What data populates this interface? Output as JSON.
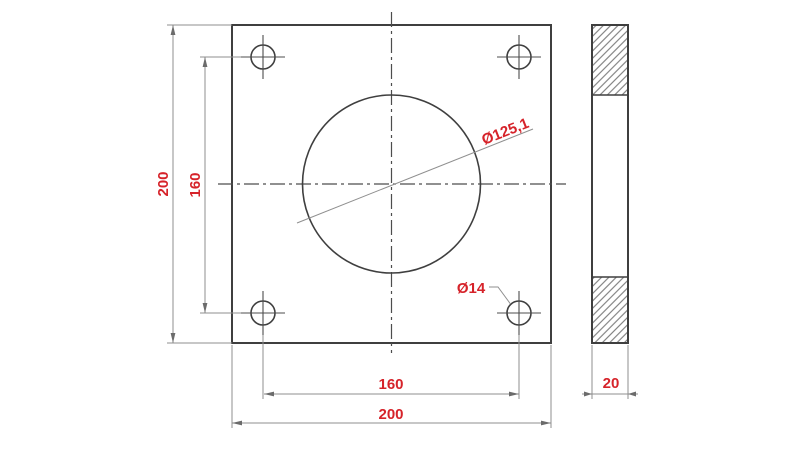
{
  "page": {
    "background": "#ffffff"
  },
  "drawing": {
    "type": "engineering-drawing",
    "subject": "square flange plate - front view with center bore and four bolt holes, plus side section view",
    "front_view": {
      "plate_height_dim": "200",
      "hole_spacing_vertical_dim": "160",
      "hole_spacing_horizontal_dim": "160",
      "plate_width_dim": "200",
      "center_hole_dia": "Ø125,1",
      "bolt_hole_dia": "Ø14"
    },
    "side_view": {
      "thickness_dim": "20"
    },
    "values": {
      "plate_width_mm": 200,
      "plate_height_mm": 200,
      "bolt_hole_spacing_mm": 160,
      "center_hole_diameter_mm": 125.1,
      "bolt_hole_diameter_mm": 14,
      "thickness_mm": 20
    },
    "colors": {
      "dimension_text": "#d6232a",
      "outline_line": "#3f3f3f",
      "thin_line": "#8f8f8f"
    }
  }
}
